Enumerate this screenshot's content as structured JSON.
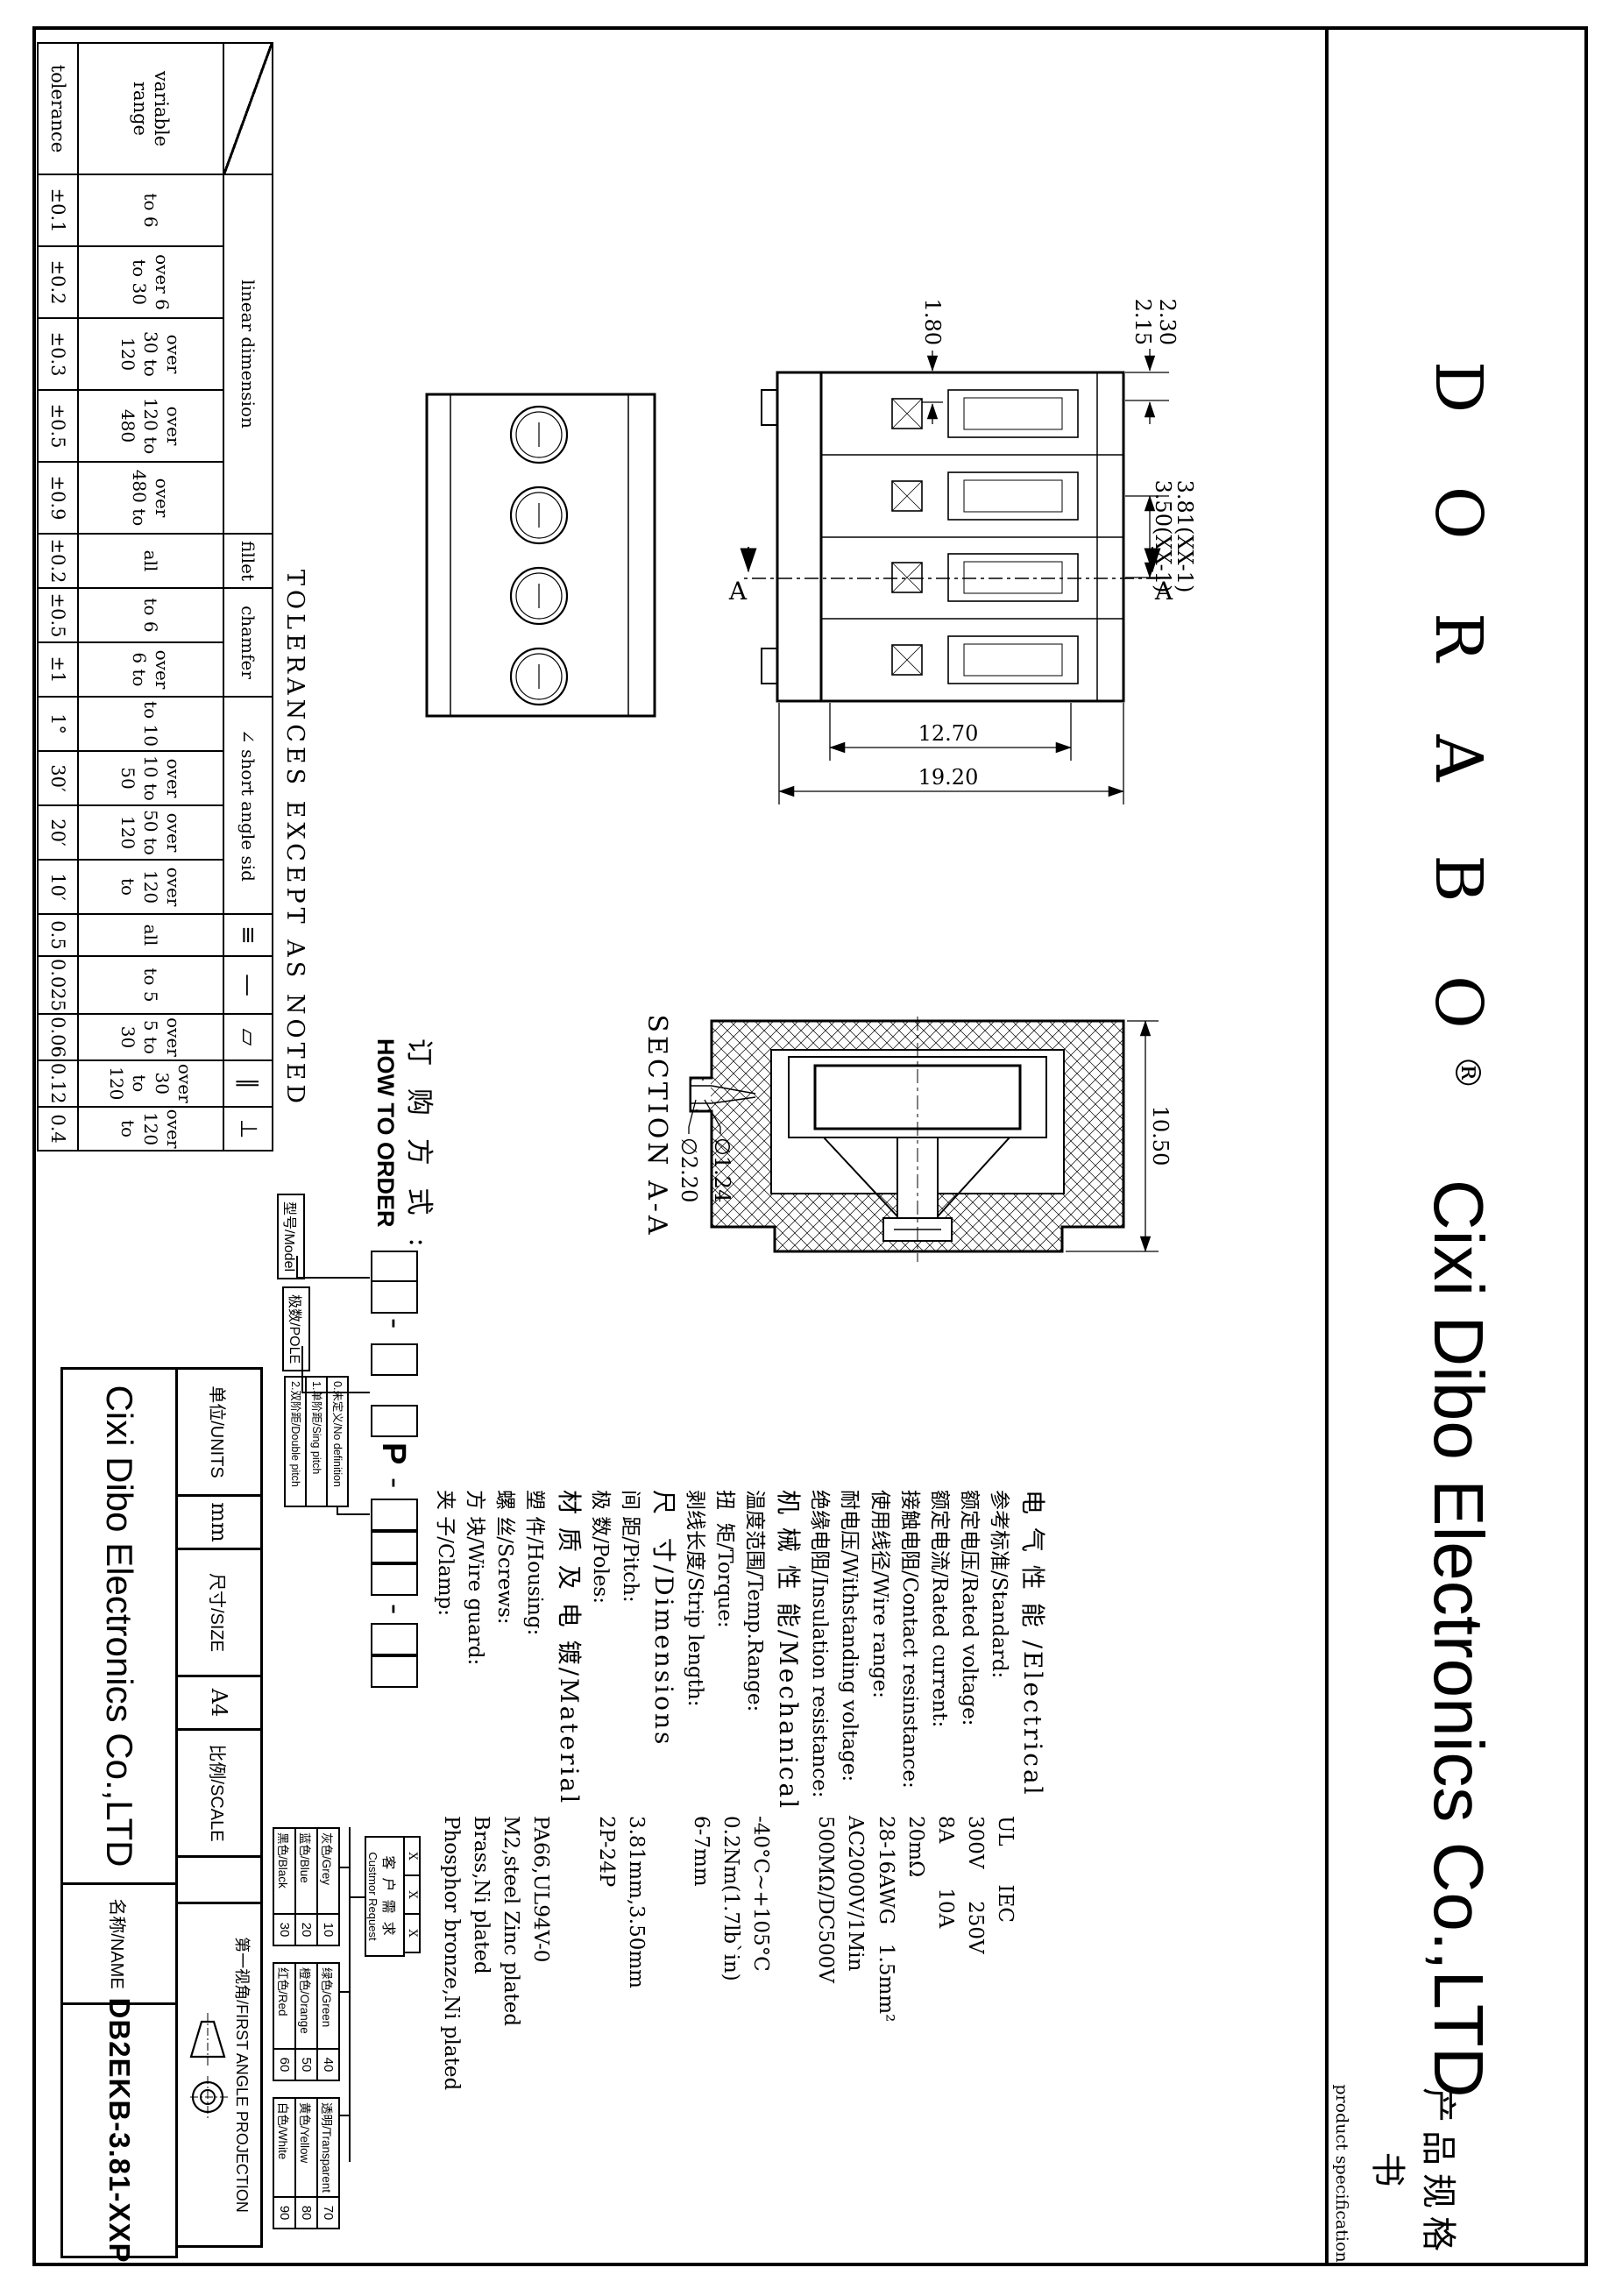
{
  "header": {
    "brand": "D O R A B O",
    "registered": "®",
    "company": "Cixi Dibo Electronics Co.,LTD",
    "doc_title_cn": "产品规格书",
    "doc_title_en": "product specification"
  },
  "tolerance_table": {
    "note": "TOLERANCES EXCEPT AS NOTED",
    "range_label": "variable range",
    "tolerance_label": "tolerance",
    "groups": [
      {
        "label": "linear dimension",
        "span": 5
      },
      {
        "label": "fillet",
        "span": 1
      },
      {
        "label": "chamfer",
        "span": 2
      },
      {
        "label": "∠ short angle sid",
        "span": 4
      },
      {
        "label": "≡",
        "span": 1,
        "sym": true
      },
      {
        "label": "—",
        "span": 1,
        "sym": true
      },
      {
        "label": "▱",
        "span": 1,
        "sym": true
      },
      {
        "label": "∥",
        "span": 1,
        "sym": true
      },
      {
        "label": "⊥",
        "span": 1,
        "sym": true
      }
    ],
    "ranges": [
      "to 6",
      "over 6 to 30",
      "over 30 to 120",
      "over 120 to 480",
      "over 480 to",
      "all",
      "to 6",
      "over 6 to",
      "to 10",
      "over 10 to 50",
      "over 50 to 120",
      "over 120 to",
      "all",
      "to 5",
      "over 5 to 30",
      "over 30 to 120",
      "over 120 to"
    ],
    "tolerances": [
      "±0.1",
      "±0.2",
      "±0.3",
      "±0.5",
      "±0.9",
      "±0.2",
      "±0.5",
      "±1",
      "1°",
      "30′",
      "20′",
      "10′",
      "0.5",
      "0.025",
      "0.06",
      "0.12",
      "0.4"
    ]
  },
  "drawing": {
    "side_view": {
      "pitch1": "3.81(XX-1)",
      "pitch2": "3.50(XX-1)",
      "dim_230": "2.30",
      "dim_215": "2.15",
      "dim_180": "1.80",
      "dim_1270": "12.70",
      "dim_1920": "19.20",
      "section_letter": "A"
    },
    "section_view": {
      "caption": "SECTION A-A",
      "dim_1050": "10.50",
      "dia_124": "∅1.24",
      "dia_220": "∅2.20"
    }
  },
  "specs": [
    {
      "h": true,
      "label": "电 气 性 能 /Electrical"
    },
    {
      "label": "参考标准/Standard:",
      "value": "UL      IEC"
    },
    {
      "label": "额定电压/Rated voltage:",
      "value": "300V     250V"
    },
    {
      "label": "额定电流/Rated current:",
      "value": "8A       10A"
    },
    {
      "label": "接触电阻/Contact resinstance:",
      "value": "20mΩ"
    },
    {
      "label": "使用线径/Wire range:",
      "value": "28-16AWG   1.5mm²"
    },
    {
      "label": "耐电压/Withstanding voltage:",
      "value": "AC2000V/1Min"
    },
    {
      "label": "绝缘电阻/Insulation resistance:",
      "value": "500MΩ/DC500V"
    },
    {
      "h": true,
      "label": "机 械 性 能/Mechanical"
    },
    {
      "label": "温度范围/Temp.Range:",
      "value": "-40°C~+105°C"
    },
    {
      "label": "扭  矩/Torque:",
      "value": "0.2Nm(1.7lb`in)"
    },
    {
      "label": "剥线长度/Strip length:",
      "value": "6-7mm"
    },
    {
      "h": true,
      "label": "尺  寸/Dimensions"
    },
    {
      "label": "间 距/Pitch:",
      "value": "3.81mm,3.50mm"
    },
    {
      "label": "极 数/Poles:",
      "value": "2P-24P"
    },
    {
      "h": true,
      "label": "材 质 及 电 镀/Material"
    },
    {
      "label": "塑 件/Housing:",
      "value": "PA66,UL94V-0"
    },
    {
      "label": "螺 丝/Screws:",
      "value": "M2,steel Zinc plated"
    },
    {
      "label": "方 块/Wire guard:",
      "value": "Brass,Ni plated"
    },
    {
      "label": "夹 子/Clamp:",
      "value": "Phosphor bronze,Ni plated"
    }
  ],
  "how_to_order": {
    "title_cn": "订 购 方 式 :",
    "title_en": "HOW TO ORDER",
    "model_label": "型号/Model",
    "pole_label": "极数/POLE",
    "fixed_letter": "P",
    "dash": "-",
    "x_mark": "X",
    "pitch_options": [
      "0.未定义/No definition",
      "1.单阶距/Sing pitch",
      "2.双阶距/Double pitch"
    ],
    "customer_request_cn": "客 户 需 求",
    "customer_request_en": "Custmor Request",
    "color_tables": [
      [
        {
          "name": "灰色/Grey",
          "code": "10"
        },
        {
          "name": "蓝色/Blue",
          "code": "20"
        },
        {
          "name": "黑色/Black",
          "code": "30"
        }
      ],
      [
        {
          "name": "绿色/Green",
          "code": "40"
        },
        {
          "name": "橙色/Orange",
          "code": "50"
        },
        {
          "name": "红色/Red",
          "code": "60"
        }
      ],
      [
        {
          "name": "透明/Transparent",
          "code": "70"
        },
        {
          "name": "黄色/Yellow",
          "code": "80"
        },
        {
          "name": "白色/White",
          "code": "90"
        }
      ]
    ]
  },
  "title_block": {
    "units_label": "单位/UNITS",
    "units_value": "mm",
    "size_label": "尺寸/SIZE",
    "size_value": "A4",
    "scale_label": "比例/SCALE",
    "scale_value": "",
    "projection_label": "第一视角/FIRST ANGLE PROJECTION",
    "company": "Cixi Dibo Electronics Co.,LTD",
    "name_label": "名称/NAME",
    "name_value": "DB2EKB-3.81-XXP"
  },
  "colors": {
    "ink": "#000000",
    "paper": "#ffffff"
  }
}
